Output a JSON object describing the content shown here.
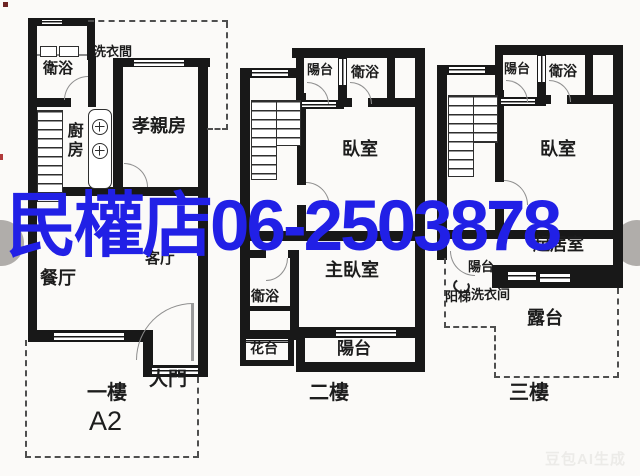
{
  "watermark": {
    "text": "民權店06-2503878",
    "color": "#2120e6"
  },
  "ai_badge": {
    "text": "豆包AI生成"
  },
  "colors": {
    "wall": "#181818",
    "watermark_blue": "#2120e6",
    "door_arc": "#8f8f8f",
    "dash_line": "#4f4f4f",
    "nav_circle": "#9e9a96",
    "background": "#fbfaf8"
  },
  "floor_plans": {
    "first": {
      "floor_label": "一樓",
      "unit_label": "A2",
      "rooms": {
        "laundry": "洗衣間",
        "bath": "衛浴",
        "kitchen": "廚房",
        "parents_room": "孝親房",
        "dining": "餐厅",
        "living": "客厅",
        "main_door": "大門"
      }
    },
    "second": {
      "floor_label": "二樓",
      "rooms": {
        "balcony_top": "陽台",
        "bath_top": "衛浴",
        "bedroom": "臥室",
        "master_bedroom": "主臥室",
        "bath_lower": "衛浴",
        "flower_bed": "花台",
        "balcony_bottom": "陽台"
      }
    },
    "third": {
      "floor_label": "三樓",
      "rooms": {
        "balcony_top": "陽台",
        "bath_top": "衛浴",
        "bedroom": "臥室",
        "living_room": "起居室",
        "balcony_small": "陽台",
        "stairs_note": "阳梯",
        "laundry_note": "洗衣间",
        "terrace": "露台"
      }
    }
  }
}
